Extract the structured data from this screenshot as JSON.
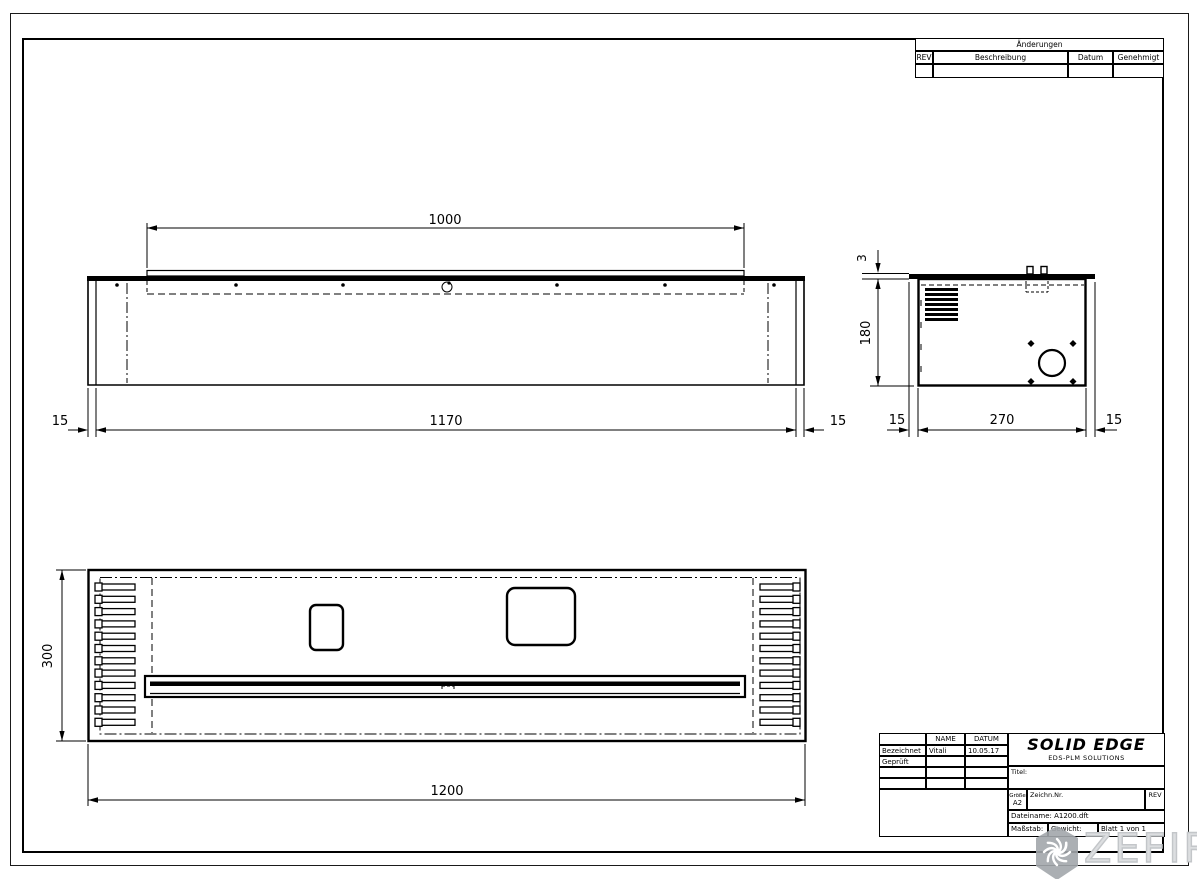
{
  "sheet": {
    "revisions_table": {
      "title": "Änderungen",
      "columns": [
        "REV",
        "Beschreibung",
        "Datum",
        "Genehmigt"
      ]
    },
    "title_block": {
      "name_header": "NAME",
      "date_header": "DATUM",
      "rows": [
        {
          "label": "Bezeichnet",
          "name": "Vitali",
          "date": "10.05.17"
        },
        {
          "label": "Geprüft",
          "name": "",
          "date": ""
        }
      ],
      "logo": "SOLID EDGE",
      "logo_sub": "EDS-PLM SOLUTIONS",
      "title_label": "Titel:",
      "size_label": "Größe",
      "size_value": "A2",
      "drawing_no_label": "Zeichn.Nr.",
      "rev_label": "REV",
      "filename": "Dateiname: A1200.dft",
      "scale_label": "Maßstab:",
      "weight_label": "Gewicht:",
      "sheet_label": "Blatt 1 von 1"
    },
    "views": {
      "front": {
        "dims": {
          "top": "1000",
          "bottom": "1170",
          "left": "15",
          "right": "15"
        }
      },
      "side": {
        "dims": {
          "thickness": "3",
          "height": "180",
          "left": "15",
          "width": "270",
          "right": "15"
        }
      },
      "plan": {
        "dims": {
          "height": "300",
          "width": "1200"
        }
      }
    },
    "watermark": "ZEFIRE"
  }
}
